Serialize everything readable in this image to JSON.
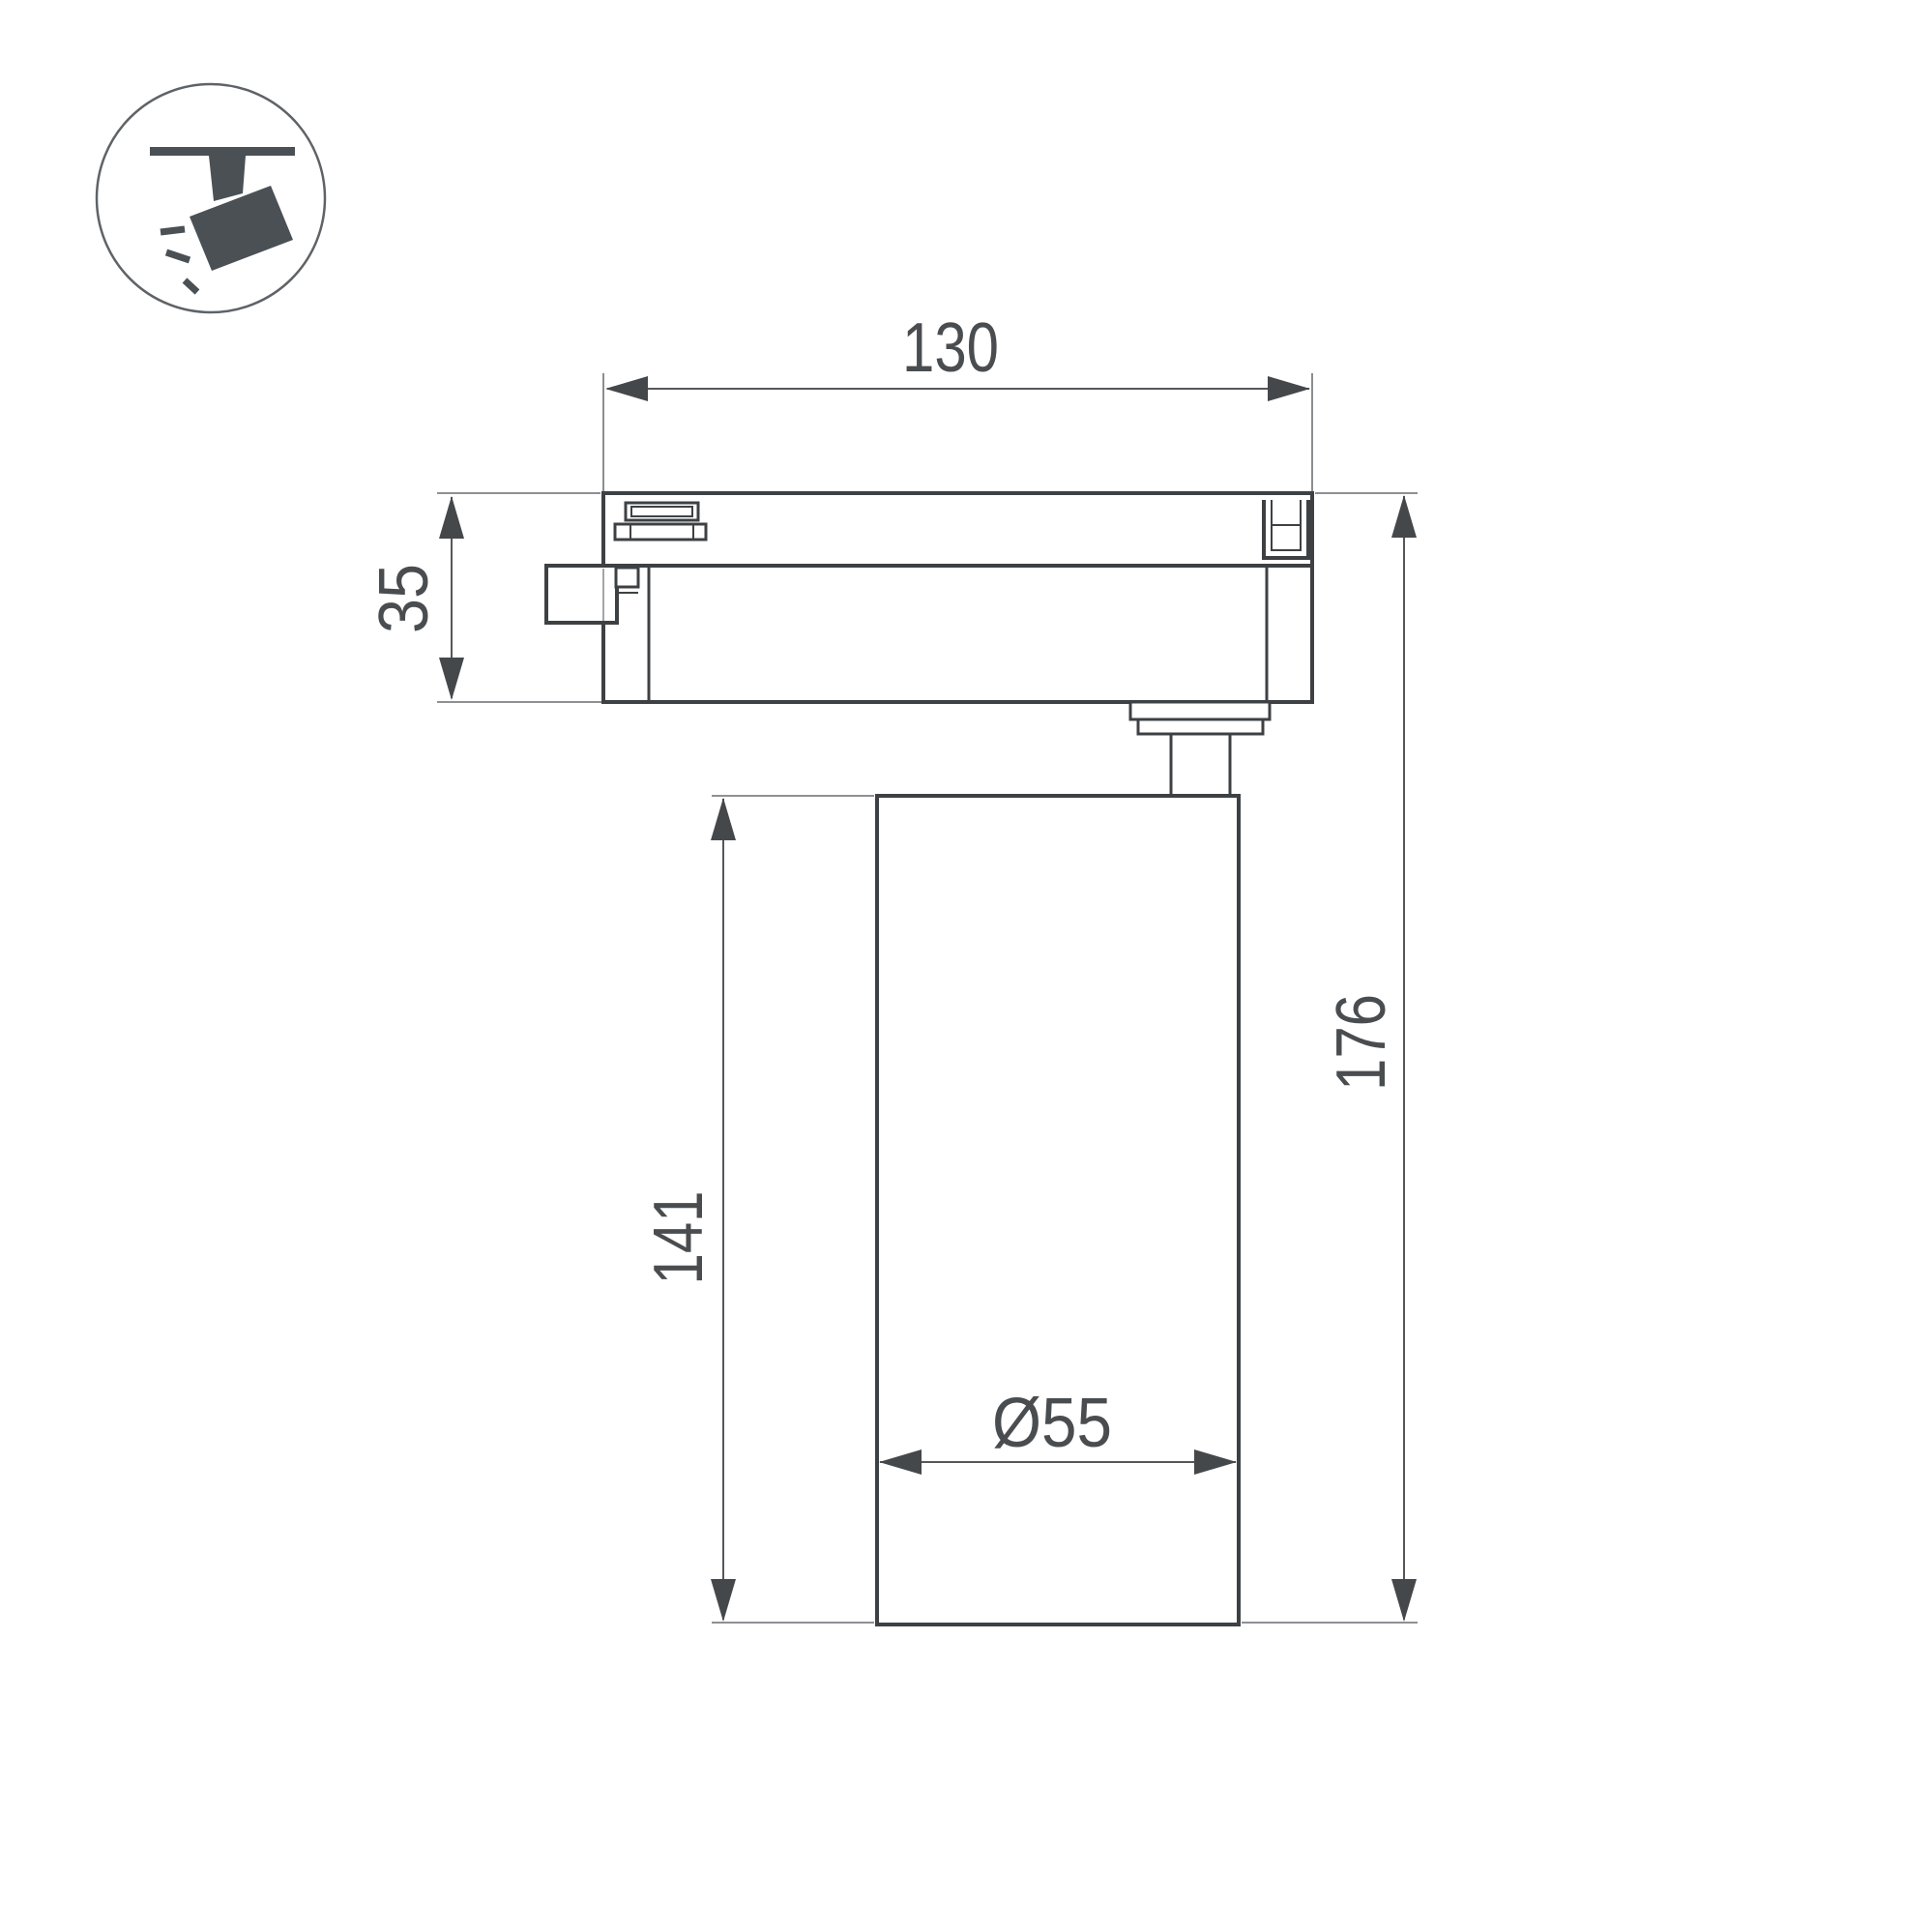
{
  "drawing": {
    "labels": {
      "adapter_width": "130",
      "adapter_height": "35",
      "body_height": "141",
      "overall_height": "176",
      "diameter": "Ø55"
    },
    "icon": {
      "name": "track-spotlight-icon"
    },
    "colors": {
      "outline": "#3e4144",
      "dimension_line": "#55585b",
      "extension_line": "#7e8184",
      "arrow": "#45484b",
      "text": "#4a4d50",
      "icon_fill": "#4b5055",
      "background": "#ffffff"
    }
  }
}
